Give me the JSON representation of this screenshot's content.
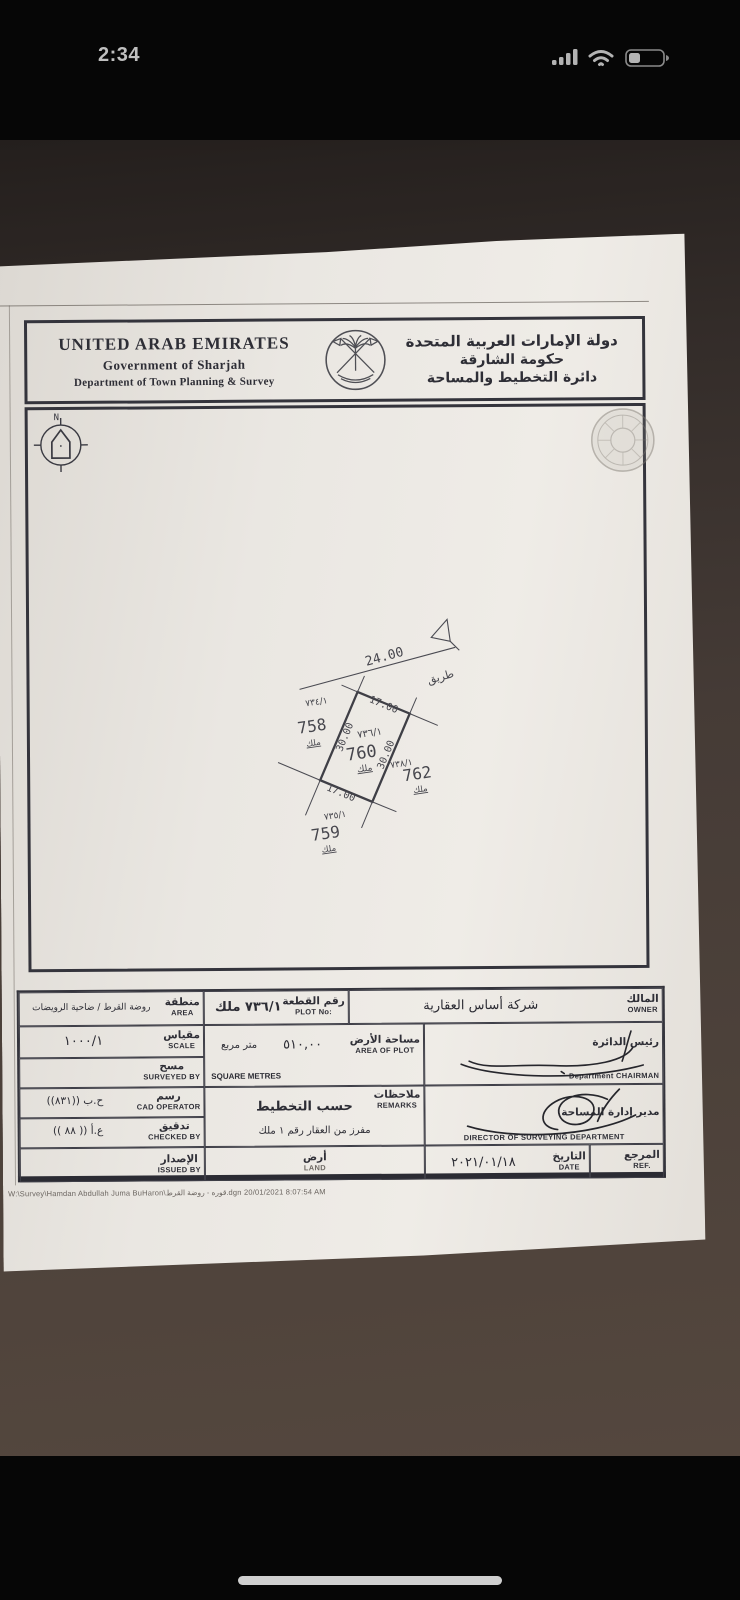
{
  "status_bar": {
    "time": "2:34"
  },
  "header": {
    "en": {
      "line1": "UNITED ARAB EMIRATES",
      "line2": "Government of Sharjah",
      "line3": "Department of Town Planning &  Survey"
    },
    "ar": {
      "line1": "دولة الإمارات العربية المتحدة",
      "line2": "حكومة الشارقة",
      "line3": "دائرة التخطيط والمساحة"
    }
  },
  "compass": {
    "north_label": "N"
  },
  "drawing": {
    "road": {
      "width_label": "24.00",
      "name_ar": "طريق"
    },
    "plot": {
      "parcel": "٧٣٦/١",
      "number": "760",
      "tenure": "ملك",
      "front_dim": "17.00",
      "back_dim": "17.00",
      "left_dim": "30.00",
      "right_dim": "30.00"
    },
    "neighbors": [
      {
        "parcel": "٧٣٤/١",
        "number": "758",
        "tenure": "ملك"
      },
      {
        "parcel": "٧٣٨/١",
        "number": "762",
        "tenure": "ملك"
      },
      {
        "parcel": "٧٣٥/١",
        "number": "759",
        "tenure": "ملك"
      }
    ]
  },
  "table": {
    "area": {
      "label_ar": "منطقة",
      "label_en": "AREA",
      "value": "روضة القرط / ضاحية الرويضات"
    },
    "plot_no": {
      "label_ar": "رقم القطعة",
      "label_en": "PLOT No:",
      "value": "٧٣٦/١ ملك"
    },
    "owner": {
      "label_ar": "المالك",
      "label_en": "OWNER",
      "value": "شركة أساس العقارية"
    },
    "scale": {
      "label_ar": "مقياس",
      "label_en": "SCALE",
      "value": "١٠٠٠/١"
    },
    "area_of_plot": {
      "label_ar": "مساحة الأرض",
      "label_en": "AREA OF PLOT",
      "value": "٥١٠,٠٠",
      "unit_ar": "متر مربع",
      "unit_en": "SQUARE METRES"
    },
    "chairman": {
      "label_ar": "رئيس الدائرة",
      "label_en": "Department CHAIRMAN"
    },
    "surveyed_by": {
      "label_ar": "مسح",
      "label_en": "SURVEYED BY",
      "value": ""
    },
    "cad_operator": {
      "label_ar": "رسم",
      "label_en": "CAD OPERATOR",
      "value": "ح.ب ((٨٣١))"
    },
    "remarks": {
      "label_ar": "ملاحظات",
      "label_en": "REMARKS",
      "value1": "حسب التخطيط",
      "value2": "مفرز من العقار رقم ١ ملك"
    },
    "director": {
      "label_ar": "مدير إدارة المساحة",
      "label_en": "DIRECTOR OF SURVEYING DEPARTMENT"
    },
    "checked_by": {
      "label_ar": "تدقيق",
      "label_en": "CHECKED BY",
      "value": "ع.أ (( ٨٨ ))"
    },
    "issued_by": {
      "label_ar": "الإصدار",
      "label_en": "ISSUED BY",
      "value": ""
    },
    "land": {
      "label_ar": "أرض",
      "label_en": "LAND"
    },
    "date": {
      "label_ar": "التاريخ",
      "label_en": "DATE",
      "value": "٢٠٢١/٠١/١٨"
    },
    "ref": {
      "label_ar": "المرجع",
      "label_en": "REF."
    }
  },
  "footer": {
    "file_path": "W:\\Survey\\Hamdan Abdullah Juma BuHaron\\قوره - روضة القرط.dgn  20/01/2021  8:07:54 AM"
  }
}
